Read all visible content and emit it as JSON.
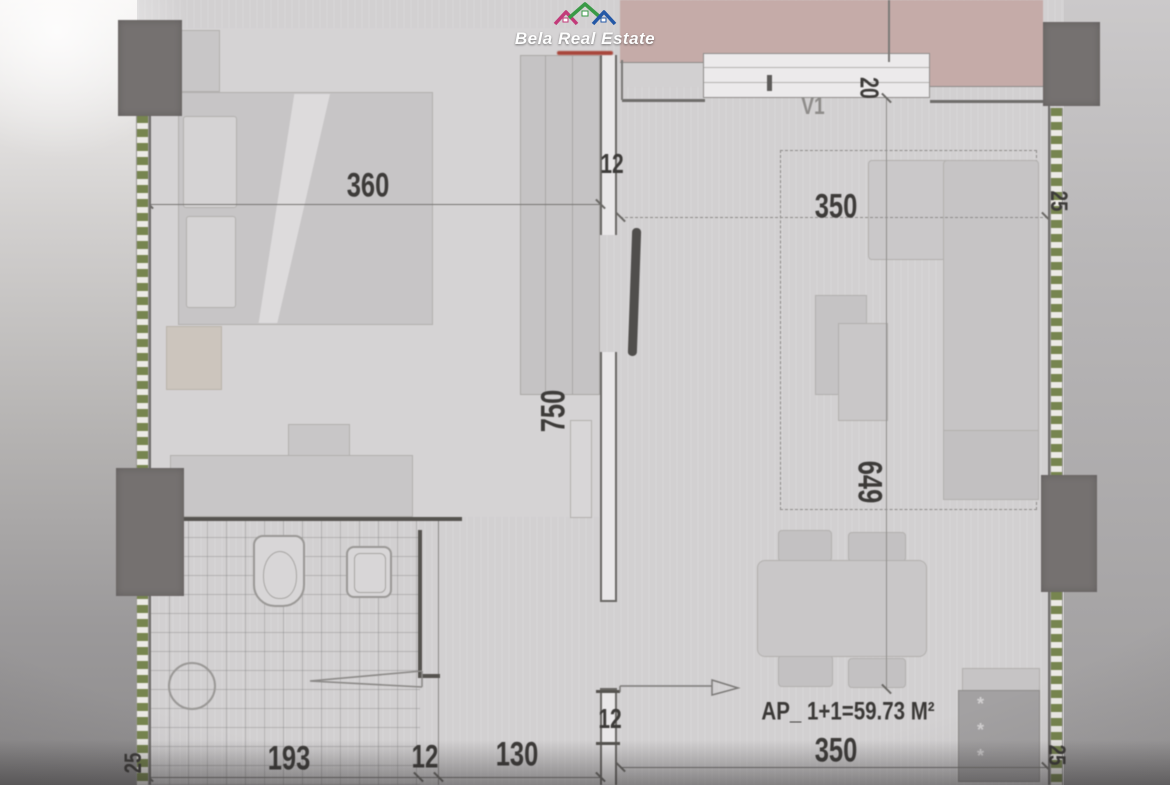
{
  "brand": {
    "name": "Bela Real Estate",
    "colors": {
      "magenta": "#c23b7a",
      "green": "#3a9a47",
      "blue": "#2458a6",
      "url_red": "#a8453a"
    }
  },
  "plan": {
    "area_label": "AP_ 1+1=59.73 M²",
    "window_label": "V1",
    "radiator_star": "*",
    "dims": {
      "bedroom_width": "360",
      "top_right_width": "350",
      "window_depth": "20",
      "corridor_length": "750",
      "living_length": "649",
      "wall_top": "12",
      "wall_entrance": "12",
      "bath_width": "193",
      "bath_wall": "12",
      "hall_width": "130",
      "bottom_right_width": "350",
      "right_wall": "25",
      "bottom_left_wall": "25",
      "bottom_right_wall": "25"
    }
  }
}
